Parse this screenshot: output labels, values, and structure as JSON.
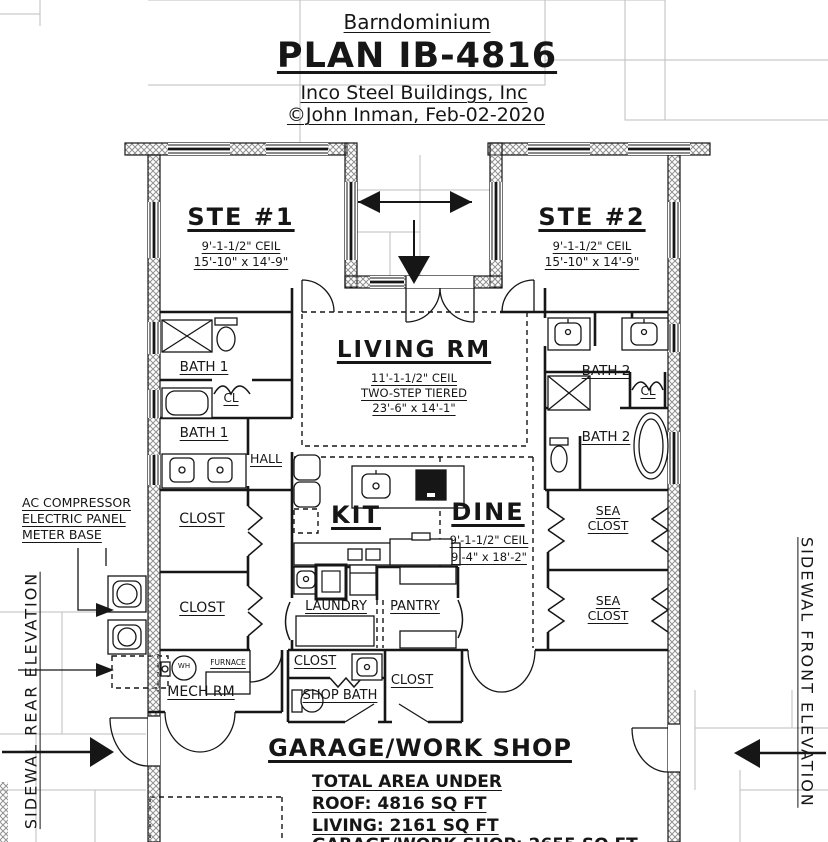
{
  "title_block": {
    "subtitle": "Barndominium",
    "plan": "PLAN IB-4816",
    "company": "Inco Steel Buildings, Inc",
    "copyright": "©John Inman, Feb-02-2020"
  },
  "rooms": {
    "ste1": {
      "name": "STE #1",
      "ceil": "9'-1-1/2\" CEIL",
      "size": "15'-10\" x 14'-9\""
    },
    "ste2": {
      "name": "STE #2",
      "ceil": "9'-1-1/2\" CEIL",
      "size": "15'-10\" x 14'-9\""
    },
    "living": {
      "name": "LIVING RM",
      "ceil": "11'-1-1/2\" CEIL",
      "note": "TWO-STEP TIERED",
      "size": "23'-6\" x 14'-1\""
    },
    "kit": {
      "name": "KIT"
    },
    "dine": {
      "name": "DINE",
      "ceil": "9'-1-1/2\" CEIL",
      "size": "9'-4\" x 18'-2\""
    },
    "bath1_upper": "BATH 1",
    "bath1_lower": "BATH 1",
    "cl_left": "CL",
    "hall": "HALL",
    "bath2_upper": "BATH 2",
    "bath2_lower": "BATH 2",
    "cl_right": "CL",
    "closet_left_1": "CLOST",
    "closet_left_2": "CLOST",
    "sea_closet_1": {
      "line1": "SEA",
      "line2": "CLOST"
    },
    "sea_closet_2": {
      "line1": "SEA",
      "line2": "CLOST"
    },
    "laundry": "LAUNDRY",
    "pantry": "PANTRY",
    "mech": "MECH RM",
    "closet_center": "CLOST",
    "shop_bath": "SHOP BATH",
    "closet_right": "CLOST",
    "garage": "GARAGE/WORK SHOP"
  },
  "equipment": {
    "water_heater": "WH",
    "furnace": "FURNACE"
  },
  "annotations": {
    "line1": "AC COMPRESSOR",
    "line2": "ELECTRIC PANEL",
    "line3": "METER BASE"
  },
  "elevations": {
    "left": "SIDEWAL REAR ELEVATION",
    "right": "SIDEWAL FRONT ELEVATION"
  },
  "totals": {
    "line1": "TOTAL AREA UNDER",
    "line2": "ROOF: 4816 SQ FT",
    "line3": "LIVING: 2161 SQ FT",
    "clipped": "GARAGE/WORK SHOP: 2655 SQ FT"
  },
  "colors": {
    "ink": "#161616",
    "grid": "#bdbdbd",
    "hatch": "#909090"
  }
}
